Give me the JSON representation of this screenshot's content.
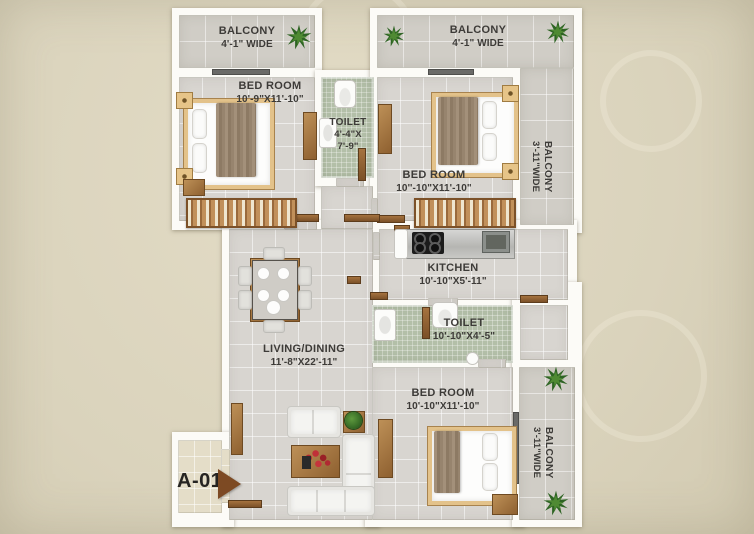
{
  "unit_label": "A-01",
  "rooms": {
    "balcony_top_left": {
      "name": "BALCONY",
      "dims": "4'-1\" WIDE"
    },
    "balcony_top_right": {
      "name": "BALCONY",
      "dims": "4'-1\" WIDE"
    },
    "balcony_right_upper": {
      "name": "BALCONY",
      "dims": "3'-11\"WIDE"
    },
    "balcony_right_lower": {
      "name": "BALCONY",
      "dims": "3'-11\"WIDE"
    },
    "bedroom_top_left": {
      "name": "BED ROOM",
      "dims": "10'-9\"X11'-10\""
    },
    "bedroom_top_right": {
      "name": "BED ROOM",
      "dims": "10''-10\"X11'-10\""
    },
    "bedroom_bottom": {
      "name": "BED ROOM",
      "dims": "10'-10\"X11'-10\""
    },
    "toilet_top": {
      "name": "TOILET",
      "dims_line1": "4'-4\"X",
      "dims_line2": "7'-9\""
    },
    "toilet_middle": {
      "name": "TOILET",
      "dims": "10'-10\"X4'-5\""
    },
    "kitchen": {
      "name": "KITCHEN",
      "dims": "10'-10\"X5'-11\""
    },
    "living_dining": {
      "name": "LIVING/DINING",
      "dims": "11'-8\"X22'-11\""
    }
  },
  "colors": {
    "background": "#dad3bc",
    "wall": "#fcfbf7",
    "room_tile": "#d8d5d0",
    "balcony_tile": "#d0cdc6",
    "toilet_tile": "#b3bfa8",
    "entry_tile": "#e4ddc8",
    "wood": "#9c6b3f",
    "arrow": "#7d4a23",
    "plant_green": "#2e6424",
    "label_text": "#3d3b38"
  }
}
